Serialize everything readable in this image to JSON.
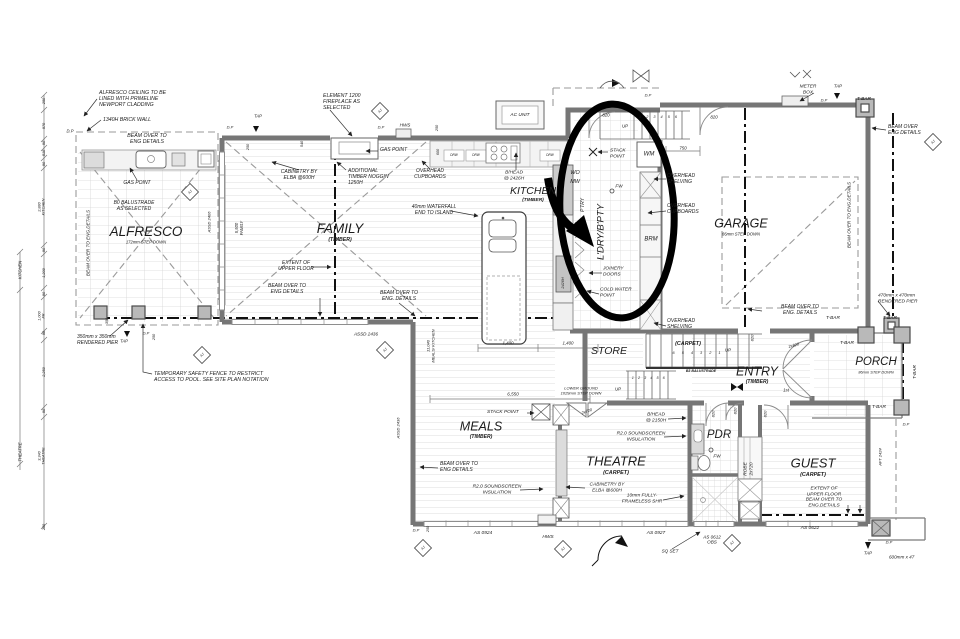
{
  "drawing": {
    "kind": "residential floor plan",
    "ink": "#1b1b1b",
    "wall_color": "#767676",
    "annotation_color": "#000000"
  },
  "annotation": {
    "shape": "hand-drawn ellipse with thick arrow",
    "target_room": "L'DRY/B'PTY",
    "cx": 617,
    "cy": 211,
    "rx": 57,
    "ry": 107
  },
  "rooms": [
    "ALFRESCO",
    "FAMILY",
    "KITCHEN",
    "L'DRY/B'PTY",
    "GARAGE",
    "STORE",
    "ENTRY",
    "PORCH",
    "MEALS",
    "THEATRE",
    "PDR",
    "GUEST"
  ],
  "labels": [
    {
      "n": "note-alfresco-ceiling",
      "t": "ALFRESCO CEILING TO BE\nLINED WITH PRIMELINE\nNEWPORT CLADDING",
      "x": 99,
      "y": 99,
      "a": "l",
      "s": 5.2
    },
    {
      "n": "note-brick-wall",
      "t": "1340H BRICK WALL",
      "x": 103,
      "y": 120,
      "a": "l",
      "s": 5.2
    },
    {
      "n": "note-beam-alfresco",
      "t": "BEAM OVER TO\nENG DETAILS",
      "x": 147,
      "y": 139,
      "s": 5.2
    },
    {
      "n": "label-dp-alfresco",
      "t": "D.P",
      "x": 70,
      "y": 132,
      "s": 4.2
    },
    {
      "n": "note-beam-left-rot",
      "t": "BEAM OVER TO ENG.DETAILS",
      "x": 88,
      "y": 243,
      "r": -90,
      "s": 4.6
    },
    {
      "n": "note-gas-point-alfresco",
      "t": "GAS POINT",
      "x": 137,
      "y": 184,
      "s": 5
    },
    {
      "n": "note-balustrade",
      "t": "B0 BALUSTRADE\nAS SELECTED",
      "x": 134,
      "y": 207,
      "s": 5
    },
    {
      "n": "room-alfresco",
      "t": "ALFRESCO",
      "x": 146,
      "y": 232,
      "s": 13.5
    },
    {
      "n": "room-alfresco-sub",
      "t": "172mm STEP DOWN",
      "x": 146,
      "y": 243,
      "s": 4.2
    },
    {
      "n": "note-pier-350",
      "t": "350mm x 350mm\nRENDERED PIER",
      "x": 77,
      "y": 341,
      "a": "l",
      "s": 5
    },
    {
      "n": "dim-350",
      "t": "350",
      "x": 107,
      "y": 321,
      "r": -90,
      "s": 3.8
    },
    {
      "n": "note-safety-fence",
      "t": "TEMPORARY SAFETY FENCE TO RESTRICT\nACCESS TO POOL. SEE SITE PLAN NOTATION",
      "x": 154,
      "y": 377,
      "a": "l",
      "s": 5.2
    },
    {
      "n": "label-tap-sw",
      "t": "TAP",
      "x": 124,
      "y": 342,
      "s": 4.2
    },
    {
      "n": "label-dp-sw",
      "t": "D.P",
      "x": 146,
      "y": 334,
      "s": 4
    },
    {
      "n": "dim-250-sw",
      "t": "250",
      "x": 154,
      "y": 337,
      "r": -90,
      "s": 3.8
    },
    {
      "n": "label-assd2436",
      "t": "ASSD 2436",
      "x": 366,
      "y": 334,
      "s": 4.6
    },
    {
      "n": "note-fireplace",
      "t": "ELEMENT 1200\nFIREPLACE AS\nSELECTED",
      "x": 323,
      "y": 102,
      "a": "l",
      "s": 5.2
    },
    {
      "n": "label-tap-family",
      "t": "TAP",
      "x": 258,
      "y": 117,
      "s": 4.2
    },
    {
      "n": "label-dp-family-1",
      "t": "D.P",
      "x": 230,
      "y": 128,
      "s": 4
    },
    {
      "n": "label-dp-family-2",
      "t": "D.P",
      "x": 381,
      "y": 128,
      "s": 4
    },
    {
      "n": "label-hws-family",
      "t": "HWS",
      "x": 405,
      "y": 125,
      "s": 4.6
    },
    {
      "n": "note-gas-point-family",
      "t": "GAS POINT",
      "x": 380,
      "y": 151,
      "a": "l",
      "s": 5
    },
    {
      "n": "note-cabinetry-family",
      "t": "CABINETRY BY\nELBA @600H",
      "x": 299,
      "y": 176,
      "s": 5
    },
    {
      "n": "note-noggin",
      "t": "ADDITIONAL\nTIMBER NOGGIN\n1250H",
      "x": 348,
      "y": 178,
      "a": "l",
      "s": 5
    },
    {
      "n": "note-ohc-family",
      "t": "OVERHEAD\nCUPBOARDS",
      "x": 430,
      "y": 175,
      "s": 5
    },
    {
      "n": "room-family",
      "t": "FAMILY",
      "x": 340,
      "y": 229,
      "s": 13.5
    },
    {
      "n": "room-family-sub",
      "t": "(TIMBER)",
      "x": 340,
      "y": 240,
      "s": 5.2,
      "b": 1
    },
    {
      "n": "note-waterfall",
      "t": "40mm WATERFALL\nEND TO ISLAND",
      "x": 434,
      "y": 211,
      "s": 5
    },
    {
      "n": "note-extent-family",
      "t": "EXTENT OF\nUPPER FLOOR",
      "x": 296,
      "y": 267,
      "s": 5
    },
    {
      "n": "note-beam-family-1",
      "t": "BEAM OVER TO\nENG DETAILS",
      "x": 287,
      "y": 290,
      "s": 5
    },
    {
      "n": "note-beam-family-2",
      "t": "BEAM OVER TO\nENG. DETAILS",
      "x": 399,
      "y": 297,
      "s": 5
    },
    {
      "n": "dim-5500-family",
      "t": "5,500\nFAMILY",
      "x": 240,
      "y": 228,
      "r": -90,
      "s": 4.2
    },
    {
      "n": "label-assd2406-rot",
      "t": "ASSD 2406",
      "x": 210,
      "y": 222,
      "r": -90,
      "s": 4
    },
    {
      "n": "dim-250-a",
      "t": "250",
      "x": 248,
      "y": 147,
      "r": -90,
      "s": 3.8
    },
    {
      "n": "dim-540",
      "t": "540",
      "x": 302,
      "y": 144,
      "r": -90,
      "s": 3.8
    },
    {
      "n": "dim-250-b",
      "t": "250",
      "x": 437,
      "y": 128,
      "r": -90,
      "s": 3.8
    },
    {
      "n": "dim-600",
      "t": "600",
      "x": 438,
      "y": 152,
      "r": -90,
      "s": 3.8
    },
    {
      "n": "label-ac-unit",
      "t": "AC UNIT",
      "x": 520,
      "y": 116,
      "s": 4.8
    },
    {
      "n": "note-bhead-kitchen",
      "t": "B/HEAD\n@ 2426H",
      "x": 514,
      "y": 176,
      "s": 4.8
    },
    {
      "n": "room-kitchen",
      "t": "KITCHEN",
      "x": 533,
      "y": 191,
      "s": 10.5
    },
    {
      "n": "room-kitchen-sub",
      "t": "(TIMBER)",
      "x": 533,
      "y": 201,
      "s": 4.8,
      "b": 1
    },
    {
      "n": "label-drw-1",
      "t": "DRW",
      "x": 454,
      "y": 156,
      "s": 3.2
    },
    {
      "n": "label-drw-2",
      "t": "DRW",
      "x": 476,
      "y": 156,
      "s": 3.2
    },
    {
      "n": "label-drw-3",
      "t": "DRW",
      "x": 550,
      "y": 156,
      "s": 3.2
    },
    {
      "n": "dim-2426h-rot",
      "t": "2426H",
      "x": 563,
      "y": 283,
      "r": -90,
      "s": 3.8
    },
    {
      "n": "dim-meals-kitchen",
      "t": "11,040\nMEALS/ KITCHEN",
      "x": 431,
      "y": 346,
      "r": -90,
      "s": 4
    },
    {
      "n": "dim-1400-a",
      "t": "1,400",
      "x": 508,
      "y": 343,
      "s": 4.4
    },
    {
      "n": "dim-1400-b",
      "t": "1,400",
      "x": 568,
      "y": 343,
      "s": 4.4
    },
    {
      "n": "label-dp-ldry-top",
      "t": "D.P",
      "x": 648,
      "y": 96,
      "s": 4
    },
    {
      "n": "label-up-top",
      "t": "UP",
      "x": 625,
      "y": 126,
      "s": 4.4
    },
    {
      "n": "stair-numbers-top",
      "t": "1 2 3 4 5 6",
      "x": 659,
      "y": 117,
      "s": 3.8,
      "ls": 2
    },
    {
      "n": "door-820-landing",
      "t": "820",
      "x": 606,
      "y": 115,
      "s": 4.4
    },
    {
      "n": "door-820-garage",
      "t": "820",
      "x": 714,
      "y": 117,
      "s": 4.4
    },
    {
      "n": "dim-750",
      "t": "750",
      "x": 683,
      "y": 148,
      "s": 4.4
    },
    {
      "n": "note-stack-point-ldry",
      "t": "STACK\nPOINT",
      "x": 610,
      "y": 154,
      "a": "l",
      "s": 4.8
    },
    {
      "n": "label-wm",
      "t": "WM",
      "x": 649,
      "y": 155,
      "s": 6
    },
    {
      "n": "label-wo",
      "t": "WO",
      "x": 575,
      "y": 173,
      "s": 5.4
    },
    {
      "n": "label-mw",
      "t": "MW",
      "x": 575,
      "y": 182,
      "s": 5.4
    },
    {
      "n": "label-fw-ldry",
      "t": "FW",
      "x": 619,
      "y": 186,
      "s": 4.6
    },
    {
      "n": "room-ldry-rot",
      "t": "L'DRY/B'PTY",
      "x": 601,
      "y": 232,
      "r": -90,
      "s": 9.5
    },
    {
      "n": "label-ptry-rot",
      "t": "P'TRY",
      "x": 584,
      "y": 205,
      "r": -90,
      "s": 5
    },
    {
      "n": "note-ohs-ldry-1",
      "t": "OVERHEAD\nSHELVING",
      "x": 667,
      "y": 180,
      "a": "l",
      "s": 5
    },
    {
      "n": "note-ohc-ldry",
      "t": "OVERHEAD\nCUPBOARDS",
      "x": 667,
      "y": 210,
      "a": "l",
      "s": 5
    },
    {
      "n": "label-brm",
      "t": "BRM",
      "x": 651,
      "y": 240,
      "s": 6
    },
    {
      "n": "note-joinery-doors",
      "t": "JOINERY\nDOORS",
      "x": 603,
      "y": 272,
      "a": "l",
      "s": 4.8
    },
    {
      "n": "note-cold-water",
      "t": "COLD WATER\nPOINT",
      "x": 600,
      "y": 293,
      "a": "l",
      "s": 4.8
    },
    {
      "n": "note-ohs-ldry-2",
      "t": "OVERHEAD\nSHELVING",
      "x": 667,
      "y": 325,
      "a": "l",
      "s": 5
    },
    {
      "n": "note-meter-box",
      "t": "METER\nBOX",
      "x": 808,
      "y": 90,
      "s": 4.8
    },
    {
      "n": "label-tap-garage",
      "t": "TAP",
      "x": 838,
      "y": 86,
      "s": 4.4
    },
    {
      "n": "label-dp-garage",
      "t": "D.P",
      "x": 824,
      "y": 101,
      "s": 4
    },
    {
      "n": "label-tbar-ne",
      "t": "T-BAR",
      "x": 864,
      "y": 100,
      "s": 4.8
    },
    {
      "n": "note-beam-ne",
      "t": "BEAM OVER\nENG DETAILS",
      "x": 888,
      "y": 131,
      "a": "l",
      "s": 5
    },
    {
      "n": "room-garage",
      "t": "GARAGE",
      "x": 741,
      "y": 224,
      "s": 12.5
    },
    {
      "n": "room-garage-sub",
      "t": "86mm STEP DOWN",
      "x": 741,
      "y": 235,
      "s": 4.2
    },
    {
      "n": "note-beam-garage-rot",
      "t": "BEAM OVER TO ENG.DETAILS",
      "x": 849,
      "y": 215,
      "r": -90,
      "s": 4.6
    },
    {
      "n": "note-pier-470",
      "t": "470mm x 470mm\nRENDERED PIER",
      "x": 878,
      "y": 299,
      "a": "l",
      "s": 4.8
    },
    {
      "n": "label-tbar-garage",
      "t": "T-BAR",
      "x": 890,
      "y": 319,
      "s": 4.8
    },
    {
      "n": "note-beam-garage-bottom",
      "t": "BEAM OVER TO\nENG. DETAILS",
      "x": 800,
      "y": 311,
      "s": 5
    },
    {
      "n": "room-store",
      "t": "STORE",
      "x": 609,
      "y": 351,
      "s": 10.5
    },
    {
      "n": "label-carpet-stairs",
      "t": "(CARPET)",
      "x": 688,
      "y": 344,
      "s": 5.4,
      "b": 1
    },
    {
      "n": "stair-numbers-mid",
      "t": "6 5 4 3 2 1",
      "x": 698,
      "y": 353,
      "s": 3.8,
      "ls": 3
    },
    {
      "n": "label-up-mid",
      "t": "UP",
      "x": 728,
      "y": 350,
      "s": 4.4
    },
    {
      "n": "label-b3-balustrade",
      "t": "B3 BALUSTRADE",
      "x": 701,
      "y": 371,
      "s": 3.6,
      "b": 1
    },
    {
      "n": "stair-numbers-low",
      "t": "1 2 3 4 5 6",
      "x": 649,
      "y": 378,
      "s": 3.8,
      "ls": 1.5
    },
    {
      "n": "label-up-low",
      "t": "UP",
      "x": 618,
      "y": 389,
      "s": 4.4
    },
    {
      "n": "note-lower-ground",
      "t": "LOWER GROUND\n1029mm STEP DOWN",
      "x": 581,
      "y": 391,
      "s": 4
    },
    {
      "n": "room-entry",
      "t": "ENTRY",
      "x": 757,
      "y": 372,
      "s": 12.5
    },
    {
      "n": "room-entry-sub",
      "t": "(TIMBER)",
      "x": 757,
      "y": 383,
      "s": 5,
      "b": 1
    },
    {
      "n": "label-1st",
      "t": "1st",
      "x": 786,
      "y": 390,
      "s": 4.4
    },
    {
      "n": "door-2x820",
      "t": "2x820",
      "x": 794,
      "y": 346,
      "r": -15,
      "s": 4
    },
    {
      "n": "room-porch",
      "t": "PORCH",
      "x": 876,
      "y": 363,
      "s": 11.5
    },
    {
      "n": "room-porch-sub",
      "t": "86mm STEP DOWN",
      "x": 876,
      "y": 373,
      "s": 3.9
    },
    {
      "n": "label-tbar-porch-1",
      "t": "T-BAR",
      "x": 833,
      "y": 319,
      "s": 4.8
    },
    {
      "n": "label-tbar-porch-2",
      "t": "T-BAR",
      "x": 847,
      "y": 344,
      "s": 4.8
    },
    {
      "n": "label-tbar-porch-3",
      "t": "T-BAR",
      "x": 916,
      "y": 372,
      "r": -90,
      "s": 4.8
    },
    {
      "n": "label-tbar-porch-4",
      "t": "T-BAR",
      "x": 879,
      "y": 408,
      "s": 4.8
    },
    {
      "n": "door-820-entry",
      "t": "820",
      "x": 753,
      "y": 338,
      "r": -90,
      "s": 4
    },
    {
      "n": "dim-6550",
      "t": "6,550",
      "x": 513,
      "y": 394,
      "s": 4.6
    },
    {
      "n": "note-stack-point-meals",
      "t": "STACK POINT",
      "x": 487,
      "y": 413,
      "a": "l",
      "s": 4.8
    },
    {
      "n": "room-meals",
      "t": "MEALS",
      "x": 481,
      "y": 427,
      "s": 12.5
    },
    {
      "n": "room-meals-sub",
      "t": "(TIMBER)",
      "x": 481,
      "y": 438,
      "s": 5,
      "b": 1
    },
    {
      "n": "door-2x720",
      "t": "2x720",
      "x": 587,
      "y": 412,
      "r": -20,
      "s": 4
    },
    {
      "n": "note-bhead-2150",
      "t": "B/HEAD\n@ 2150H",
      "x": 656,
      "y": 418,
      "s": 4.8
    },
    {
      "n": "note-insul-theatre",
      "t": "R2.0 SOUNDSCREEN\nINSULATION",
      "x": 641,
      "y": 437,
      "s": 4.8
    },
    {
      "n": "room-theatre",
      "t": "THEATRE",
      "x": 616,
      "y": 461,
      "s": 13
    },
    {
      "n": "room-theatre-sub",
      "t": "(CARPET)",
      "x": 616,
      "y": 473,
      "s": 5.4,
      "b": 1
    },
    {
      "n": "note-beam-meals",
      "t": "BEAM OVER TO\nENG DETAILS",
      "x": 440,
      "y": 468,
      "a": "l",
      "s": 5
    },
    {
      "n": "note-insul-meals",
      "t": "R2.0 SOUNDSCREEN\nINSULATION",
      "x": 497,
      "y": 490,
      "s": 4.8
    },
    {
      "n": "note-cabinetry-theatre",
      "t": "CABINETRY BY\nELBA @600H",
      "x": 607,
      "y": 488,
      "s": 4.8
    },
    {
      "n": "note-frameless-shr",
      "t": "10mm FULLY-\nFRAMELESS SHR",
      "x": 642,
      "y": 499,
      "s": 4.8
    },
    {
      "n": "room-pdr",
      "t": "PDR",
      "x": 719,
      "y": 436,
      "s": 11.5
    },
    {
      "n": "label-fw-pdr",
      "t": "FW",
      "x": 717,
      "y": 456,
      "s": 4.6
    },
    {
      "n": "label-robe-rot",
      "t": "ROBE\n2x720",
      "x": 749,
      "y": 469,
      "r": -90,
      "s": 4.8
    },
    {
      "n": "room-guest",
      "t": "GUEST",
      "x": 813,
      "y": 463,
      "s": 13
    },
    {
      "n": "room-guest-sub",
      "t": "(CARPET)",
      "x": 813,
      "y": 475,
      "s": 5.4,
      "b": 1
    },
    {
      "n": "note-extent-guest",
      "t": "EXTENT OF\nUPPER FLOOR\nBEAM OVER TO\nENG.DETAILS",
      "x": 824,
      "y": 498,
      "s": 4.8
    },
    {
      "n": "label-aft2424-rot",
      "t": "AFT 2424",
      "x": 881,
      "y": 457,
      "r": -90,
      "s": 4
    },
    {
      "n": "label-dp-guest",
      "t": "D.P",
      "x": 906,
      "y": 425,
      "s": 4
    },
    {
      "n": "door-820-pdr-1",
      "t": "820",
      "x": 714,
      "y": 414,
      "r": -90,
      "s": 4
    },
    {
      "n": "door-820-pdr-2",
      "t": "820",
      "x": 736,
      "y": 411,
      "r": -90,
      "s": 4
    },
    {
      "n": "door-820-guest",
      "t": "820",
      "x": 766,
      "y": 414,
      "r": -90,
      "s": 4
    },
    {
      "n": "label-as0924",
      "t": "AS 0924",
      "x": 483,
      "y": 534,
      "s": 4.8
    },
    {
      "n": "label-hws-meals",
      "t": "HWS",
      "x": 548,
      "y": 538,
      "s": 4.8
    },
    {
      "n": "label-as0927",
      "t": "AS 0927",
      "x": 656,
      "y": 534,
      "s": 4.8
    },
    {
      "n": "label-as0612",
      "t": "AS 0612\nOBS",
      "x": 712,
      "y": 540,
      "s": 4.6
    },
    {
      "n": "label-sq-set",
      "t": "SQ SET",
      "x": 670,
      "y": 551,
      "s": 4.6
    },
    {
      "n": "label-as0622",
      "t": "AS 0622",
      "x": 810,
      "y": 529,
      "s": 4.8
    },
    {
      "n": "label-tap-se",
      "t": "TAP",
      "x": 868,
      "y": 553,
      "s": 4.4
    },
    {
      "n": "label-dp-se",
      "t": "D.P",
      "x": 889,
      "y": 543,
      "s": 4
    },
    {
      "n": "note-pier-600",
      "t": "600mm x 47",
      "x": 889,
      "y": 557,
      "a": "l",
      "s": 4.6
    },
    {
      "n": "label-dp-meals",
      "t": "D.P",
      "x": 416,
      "y": 531,
      "s": 4
    },
    {
      "n": "dim-250-meals",
      "t": "250",
      "x": 428,
      "y": 529,
      "r": -90,
      "s": 3.8
    },
    {
      "n": "label-assd2436-rot",
      "t": "ASSD 2436",
      "x": 399,
      "y": 428,
      "r": -90,
      "s": 4
    },
    {
      "n": "dim-left-250a",
      "t": "250",
      "x": 44,
      "y": 101,
      "r": -90,
      "s": 3.8
    },
    {
      "n": "dim-left-970",
      "t": "970",
      "x": 44,
      "y": 126,
      "r": -90,
      "s": 3.8
    },
    {
      "n": "dim-left-90a",
      "t": "90",
      "x": 44,
      "y": 143,
      "r": -90,
      "s": 3.8
    },
    {
      "n": "dim-left-510",
      "t": "510",
      "x": 44,
      "y": 153,
      "r": -90,
      "s": 3.8
    },
    {
      "n": "dim-left-90b",
      "t": "90",
      "x": 44,
      "y": 164,
      "r": -90,
      "s": 3.8
    },
    {
      "n": "dim-left-2880",
      "t": "2,880\nKITCHEN",
      "x": 42,
      "y": 207,
      "r": -90,
      "s": 3.8
    },
    {
      "n": "dim-left-90c",
      "t": "90",
      "x": 44,
      "y": 250,
      "r": -90,
      "s": 3.8
    },
    {
      "n": "dim-left-1200",
      "t": "1,200",
      "x": 44,
      "y": 273,
      "r": -90,
      "s": 3.8
    },
    {
      "n": "dim-left-90d",
      "t": "90",
      "x": 44,
      "y": 294,
      "r": -90,
      "s": 3.8
    },
    {
      "n": "dim-left-1000",
      "t": "1,000\nFR",
      "x": 42,
      "y": 316,
      "r": -90,
      "s": 3.8
    },
    {
      "n": "dim-left-90e",
      "t": "90",
      "x": 44,
      "y": 333,
      "r": -90,
      "s": 3.8
    },
    {
      "n": "dim-left-2250",
      "t": "2,250",
      "x": 44,
      "y": 372,
      "r": -90,
      "s": 3.8
    },
    {
      "n": "dim-left-90f",
      "t": "90",
      "x": 44,
      "y": 411,
      "r": -90,
      "s": 3.8
    },
    {
      "n": "dim-left-3340",
      "t": "3,340\nTHEATRE",
      "x": 42,
      "y": 456,
      "r": -90,
      "s": 3.8
    },
    {
      "n": "dim-left-250b",
      "t": "250",
      "x": 44,
      "y": 527,
      "r": -90,
      "s": 3.8
    },
    {
      "n": "dim-outer-kitchen",
      "t": "KITCHEN",
      "x": 21,
      "y": 270,
      "r": -90,
      "s": 4.2
    },
    {
      "n": "dim-outer-theatre",
      "t": "THEATRE",
      "x": 21,
      "y": 452,
      "r": -90,
      "s": 4.2
    },
    {
      "n": "aj-marker-1",
      "t": "AJ",
      "x": 380,
      "y": 111,
      "r": -45,
      "s": 3.4
    },
    {
      "n": "aj-marker-2",
      "t": "AJ",
      "x": 190,
      "y": 192,
      "r": -45,
      "s": 3.4
    },
    {
      "n": "aj-marker-3",
      "t": "AJ",
      "x": 202,
      "y": 355,
      "r": -45,
      "s": 3.4
    },
    {
      "n": "aj-marker-4",
      "t": "AJ",
      "x": 385,
      "y": 350,
      "r": -45,
      "s": 3.4
    },
    {
      "n": "aj-marker-5",
      "t": "AJ",
      "x": 423,
      "y": 548,
      "r": -45,
      "s": 3.4
    },
    {
      "n": "aj-marker-6",
      "t": "AJ",
      "x": 563,
      "y": 549,
      "r": -45,
      "s": 3.4
    },
    {
      "n": "aj-marker-7",
      "t": "AJ",
      "x": 732,
      "y": 543,
      "r": -45,
      "s": 3.4
    },
    {
      "n": "aj-marker-8",
      "t": "AJ",
      "x": 933,
      "y": 142,
      "r": -45,
      "s": 3.4
    }
  ]
}
